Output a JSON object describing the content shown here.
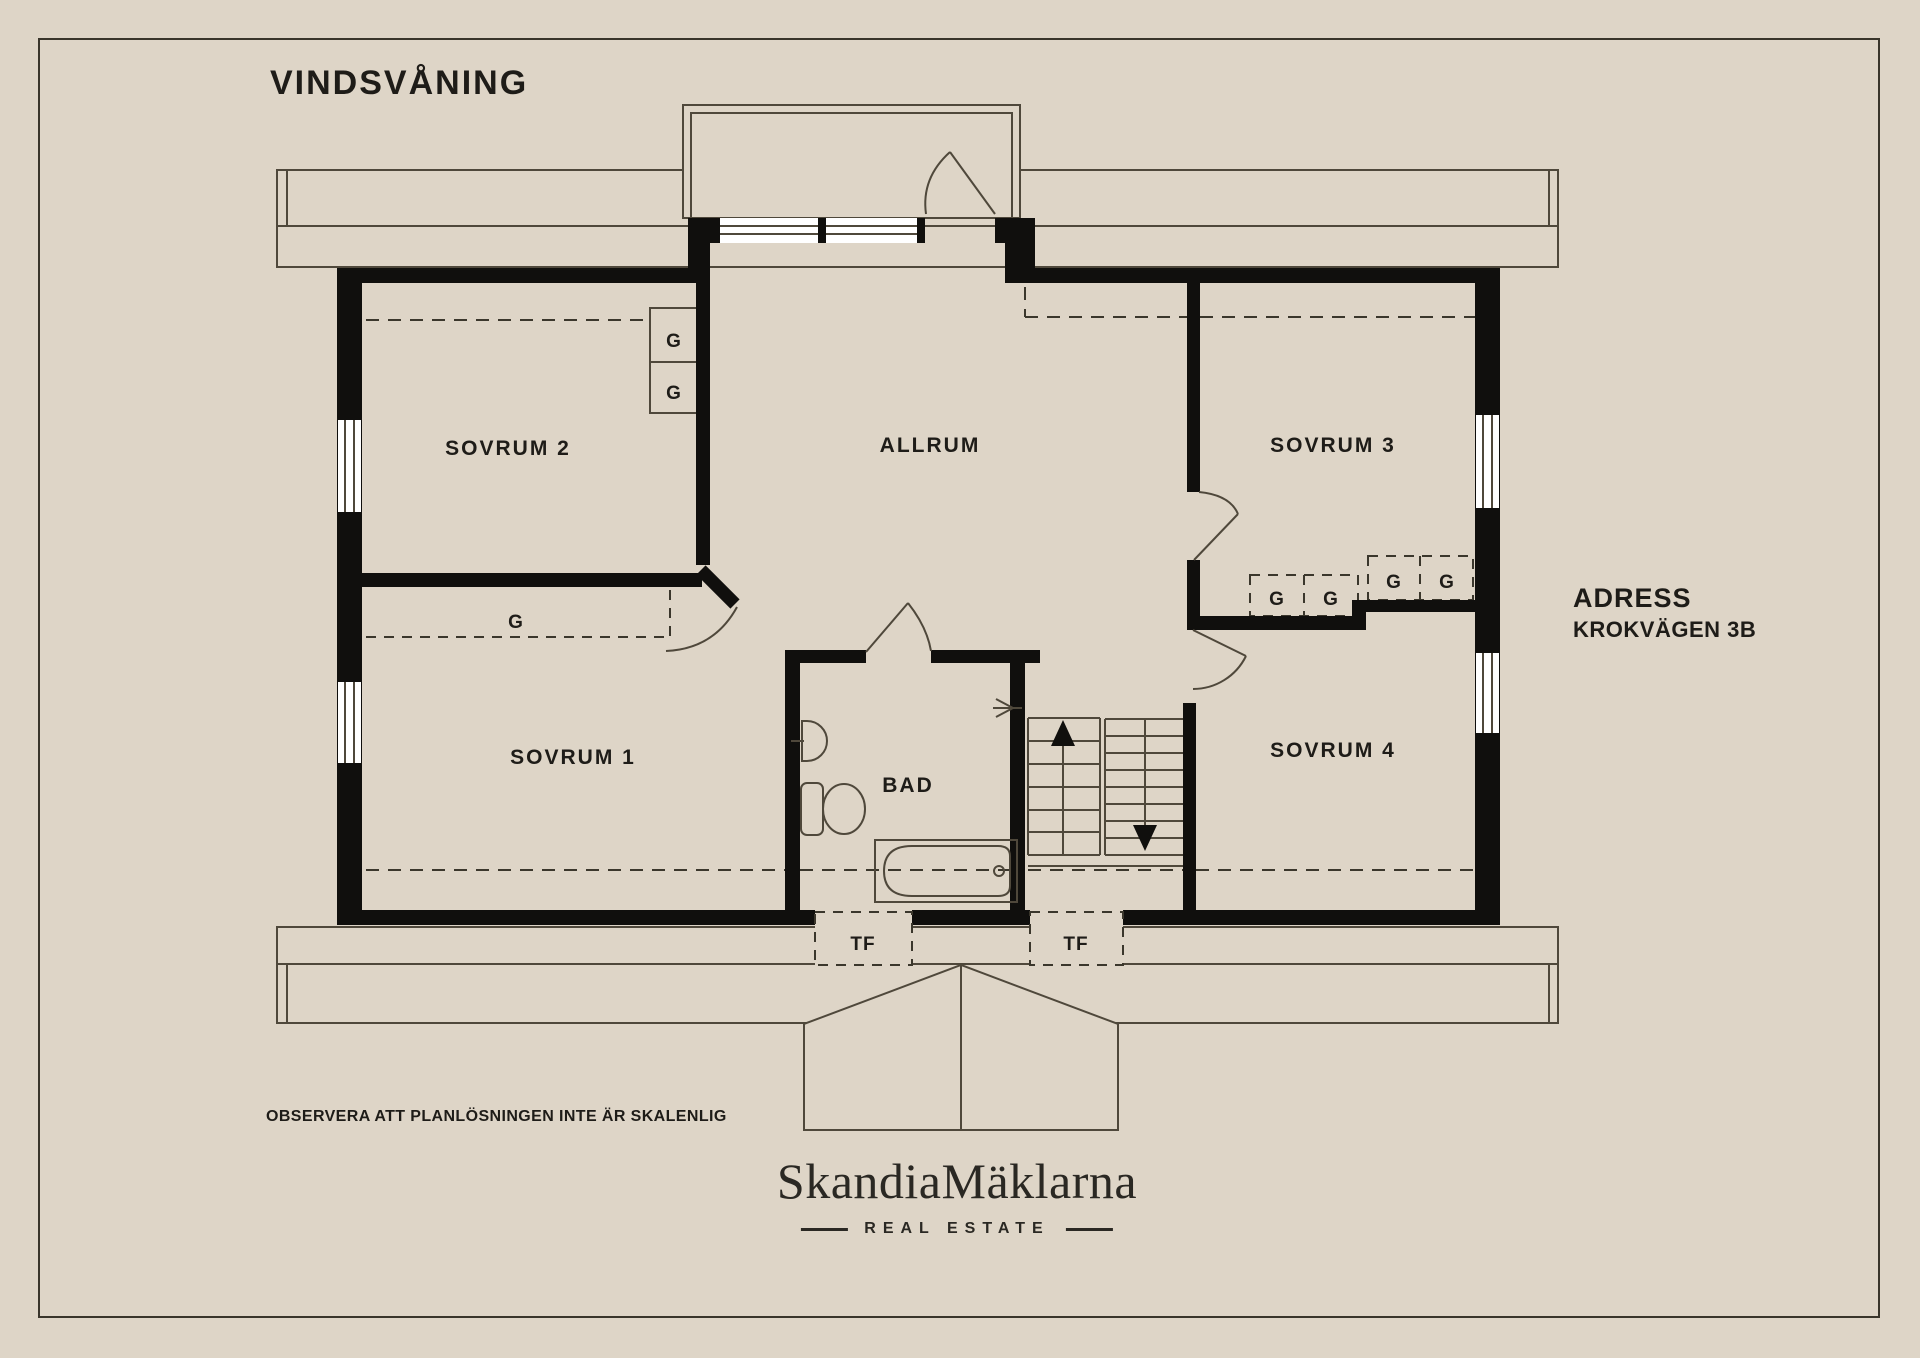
{
  "page": {
    "background": "#ded5c7",
    "frame_color": "#39352b"
  },
  "title": "VINDSVÅNING",
  "floor_plan": {
    "rooms": [
      {
        "id": "sovrum2",
        "label": "SOVRUM 2"
      },
      {
        "id": "allrum",
        "label": "ALLRUM"
      },
      {
        "id": "sovrum3",
        "label": "SOVRUM 3"
      },
      {
        "id": "sovrum1",
        "label": "SOVRUM 1"
      },
      {
        "id": "bad",
        "label": "BAD"
      },
      {
        "id": "sovrum4",
        "label": "SOVRUM 4"
      }
    ],
    "closets": [
      "G",
      "G",
      "G",
      "G",
      "G",
      "G",
      "G"
    ],
    "skylights": [
      "TF",
      "TF"
    ],
    "colors": {
      "wall": "#100f0d",
      "line": "#4f483b",
      "dashed": "#3b372c",
      "window": "#ffffff"
    }
  },
  "address": {
    "heading": "ADRESS",
    "street": "KROKVÄGEN 3B"
  },
  "disclaimer": "OBSERVERA ATT PLANLÖSNINGEN INTE ÄR SKALENLIG",
  "logo": {
    "name": "SkandiaMäklarna",
    "tagline": "REAL ESTATE"
  }
}
